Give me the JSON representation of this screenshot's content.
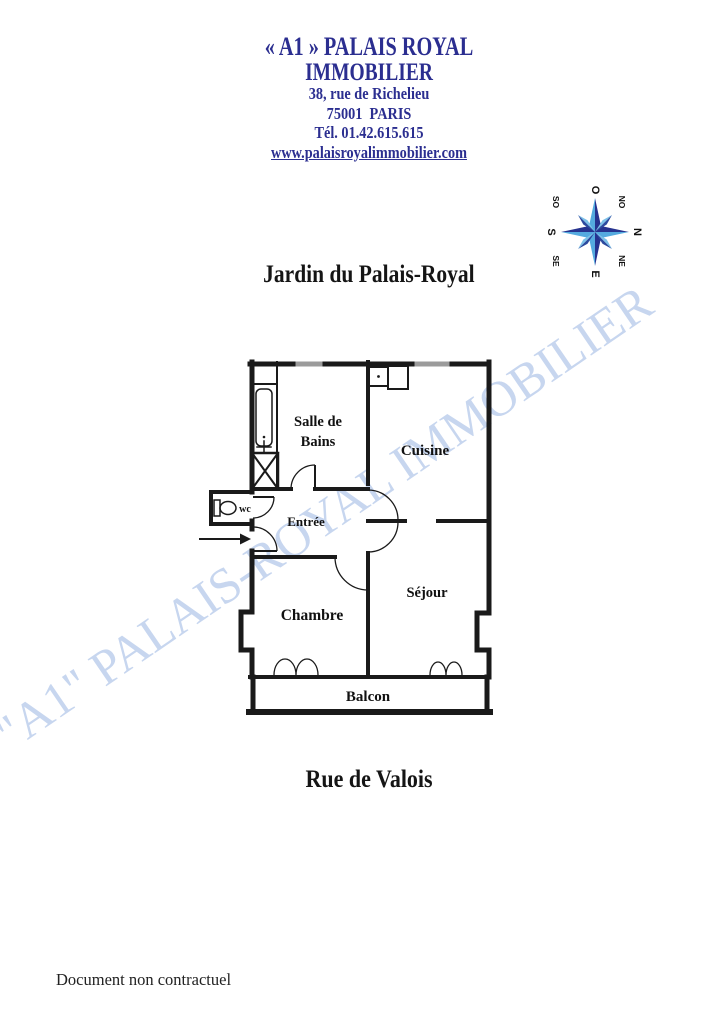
{
  "agency": {
    "name_line1": "« A1 » PALAIS ROYAL",
    "name_line2": "IMMOBILIER",
    "address_line1": "38, rue de Richelieu",
    "address_line2": "75001  PARIS",
    "phone": "Tél. 01.42.615.615",
    "website": "www.palaisroyalimmobilier.com"
  },
  "compass": {
    "labels": [
      "O",
      "NO",
      "N",
      "NE",
      "E",
      "SE",
      "S",
      "SO"
    ]
  },
  "plan": {
    "street_top": "Jardin du Palais-Royal",
    "street_bottom": "Rue de Valois",
    "rooms": {
      "bathroom_line1": "Salle de",
      "bathroom_line2": "Bains",
      "kitchen": "Cuisine",
      "entry": "Entrée",
      "wc": "wc",
      "bedroom": "Chambre",
      "living": "Séjour",
      "balcony": "Balcon"
    }
  },
  "watermark": {
    "text": "\"A1\" PALAIS-ROYAL IMMOBILIER"
  },
  "footer": {
    "note": "Document non contractuel"
  },
  "colors": {
    "header_navy": "#2b2e90",
    "watermark_blue": "#c7d6ef",
    "compass_dark": "#26338f",
    "compass_light": "#54aadf",
    "plan_ink": "#1a1a1a"
  }
}
